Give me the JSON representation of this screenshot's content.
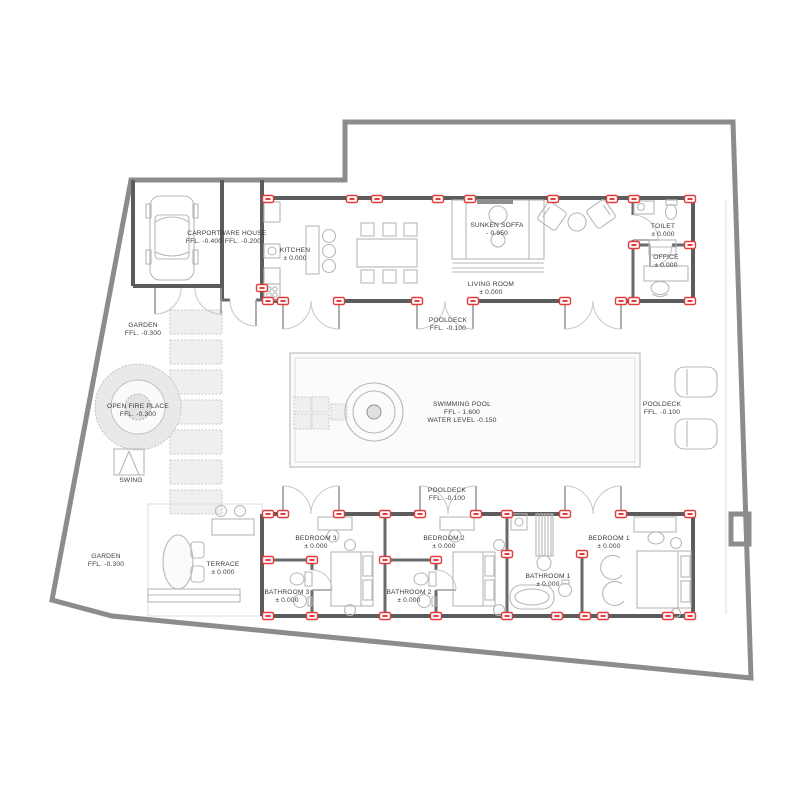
{
  "plan": {
    "carport": {
      "name": "CARPORT",
      "level": "FFL. -0.400"
    },
    "warehouse": {
      "name": "WARE HOUSE",
      "level": "FFL. -0.200"
    },
    "kitchen": {
      "name": "KITCHEN",
      "level": "± 0.000"
    },
    "sunken_soffa": {
      "name": "SUNKEN SOFFA",
      "level": "- 0.950"
    },
    "living_room": {
      "name": "LIVING ROOM",
      "level": "± 0.000"
    },
    "toilet": {
      "name": "TOILET",
      "level": "± 0.000"
    },
    "office": {
      "name": "OFFICE",
      "level": "± 0.000"
    },
    "pooldeck_top": {
      "name": "POOLDECK",
      "level": "FFL. -0.100"
    },
    "pooldeck_right": {
      "name": "POOLDECK",
      "level": "FFL. -0.100"
    },
    "pooldeck_bottom": {
      "name": "POOLDECK",
      "level": "FFL. -0.100"
    },
    "swimming_pool": {
      "name": "SWIMMING POOL",
      "level": "FFL - 1.600",
      "water": "WATER LEVEL -0.150"
    },
    "garden_top": {
      "name": "GARDEN",
      "level": "FFL. -0.300"
    },
    "garden_bottom": {
      "name": "GARDEN",
      "level": "FFL. -0.300"
    },
    "open_fire_place": {
      "name": "OPEN FIRE PLACE",
      "level": "FFL. -0.300"
    },
    "swing": {
      "name": "SWING"
    },
    "terrace": {
      "name": "TERRACE",
      "level": "± 0.000"
    },
    "bedroom_1": {
      "name": "BEDROOM 1",
      "level": "± 0.000"
    },
    "bedroom_2": {
      "name": "BEDROOM 2",
      "level": "± 0.000"
    },
    "bedroom_3": {
      "name": "BEDROOM 3",
      "level": "± 0.000"
    },
    "bathroom_1": {
      "name": "BATHROOM 1",
      "level": "± 0.000"
    },
    "bathroom_2": {
      "name": "BATHROOM 2",
      "level": "± 0.000"
    },
    "bathroom_3": {
      "name": "BATHROOM 3",
      "level": "± 0.000"
    }
  },
  "colors": {
    "wall": "#5c5c5c",
    "site_boundary": "#8c8c8c",
    "column_marker": "#e23b3b",
    "furniture": "#b8b8b8",
    "text": "#3a3a3a"
  }
}
